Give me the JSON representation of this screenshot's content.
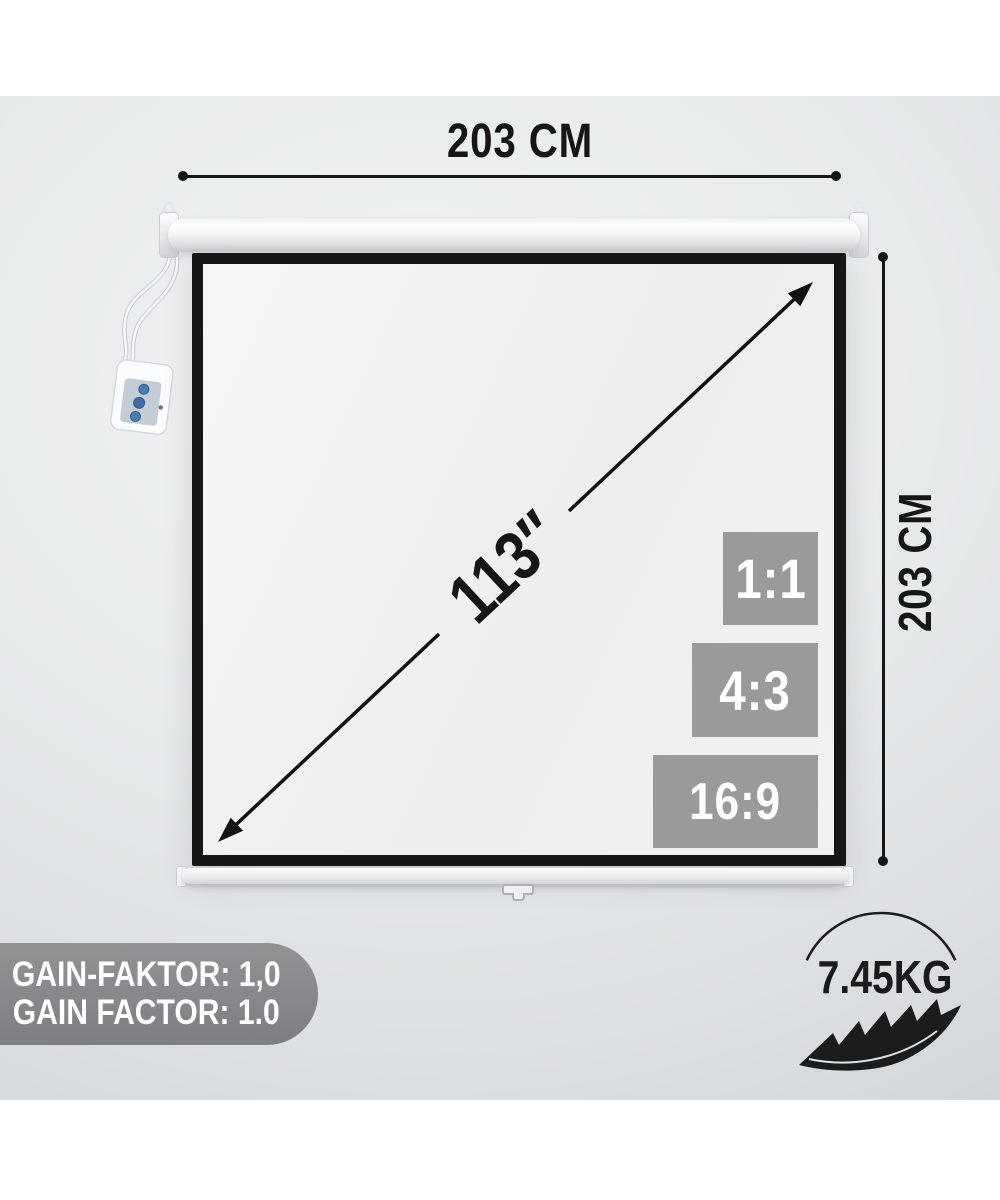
{
  "graphic": {
    "width_dimension": {
      "label": "203 CM"
    },
    "height_dimension": {
      "label": "203 CM"
    },
    "diagonal": {
      "label": "113″"
    },
    "aspect_ratio_badges": [
      {
        "label": "1:1"
      },
      {
        "label": "4:3"
      },
      {
        "label": "16:9"
      }
    ],
    "gain_badge": {
      "line1": "GAIN-FAKTOR: 1,0",
      "line2": "GAIN FACTOR: 1.0"
    },
    "weight_badge": {
      "label": "7.45KG"
    },
    "colors": {
      "ink": "#161616",
      "aspect_badge_gray": "#9a9a9a",
      "gain_badge_gray": "#87888a",
      "screen_border_black": "#171717"
    }
  }
}
